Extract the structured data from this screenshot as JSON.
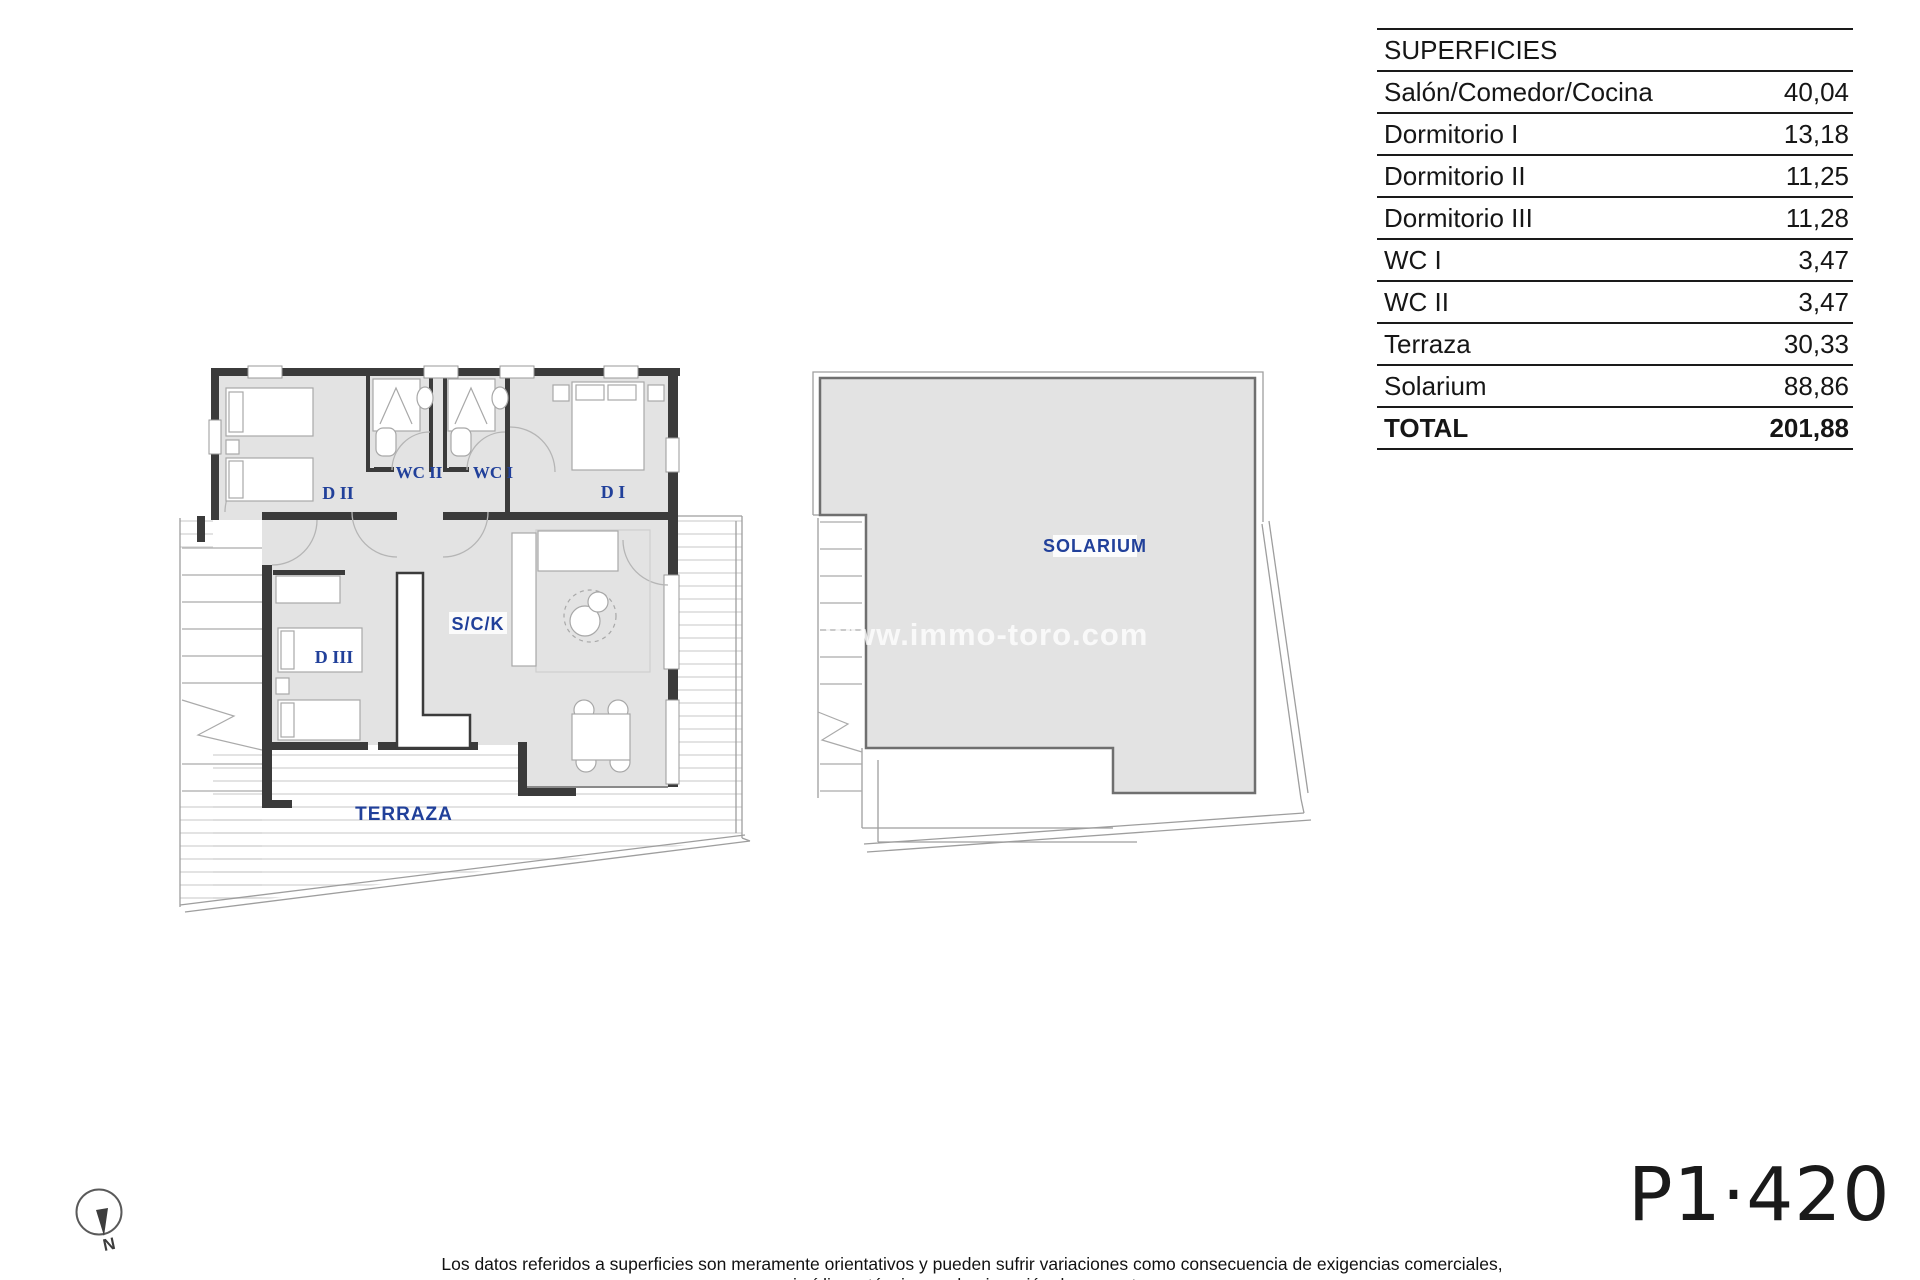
{
  "table": {
    "title": "SUPERFICIES",
    "rows": [
      {
        "label": "Salón/Comedor/Cocina",
        "value": "40,04",
        "bold": false
      },
      {
        "label": "Dormitorio I",
        "value": "13,18",
        "bold": false
      },
      {
        "label": "Dormitorio II",
        "value": "11,25",
        "bold": false
      },
      {
        "label": "Dormitorio III",
        "value": "11,28",
        "bold": false
      },
      {
        "label": "WC I",
        "value": "3,47",
        "bold": false
      },
      {
        "label": "WC II",
        "value": "3,47",
        "bold": false
      },
      {
        "label": "Terraza",
        "value": "30,33",
        "bold": false
      },
      {
        "label": "Solarium",
        "value": "88,86",
        "bold": false
      },
      {
        "label": "TOTAL",
        "value": "201,88",
        "bold": true
      }
    ]
  },
  "plan": {
    "labels": {
      "d2": "D II",
      "wc2": "WC II",
      "wc1": "WC I",
      "d1": "D I",
      "d3": "D III",
      "sck": "S/C/K",
      "terraza": "TERRAZA",
      "solarium": "SOLARIUM"
    }
  },
  "watermark": {
    "text": "www.immo-toro.com"
  },
  "compass": {
    "label": "N"
  },
  "footer": {
    "page_code": "P1·420",
    "disclaimer": "Los datos referidos a superficies son meramente orientativos y pueden sufrir variaciones como consecuencia de exigencias comerciales, jurídicas, técnicas o de ejecución de proyecto."
  },
  "colors": {
    "accent_blue": "#21409a",
    "wall_dark": "#3b3b3b",
    "room_fill": "#e3e3e3",
    "line_gray": "#9e9e9e"
  }
}
